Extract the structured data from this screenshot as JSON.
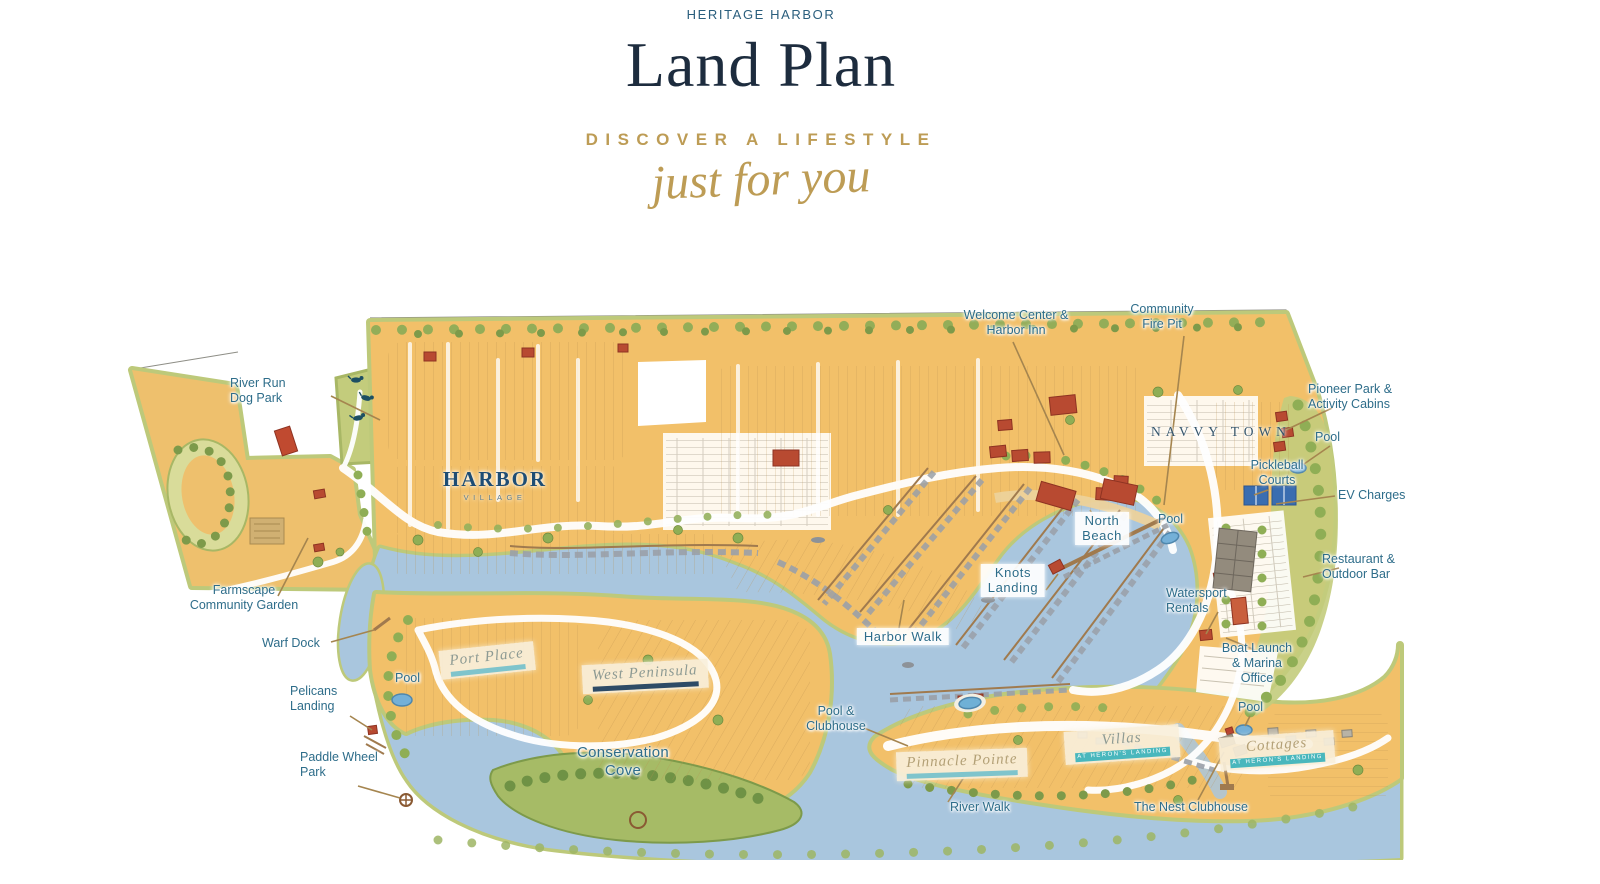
{
  "header": {
    "eyebrow": "HERITAGE HARBOR",
    "title": "Land Plan",
    "tagline": "DISCOVER A LIFESTYLE",
    "script_line": "just for you"
  },
  "map": {
    "districts": {
      "harbor_village": {
        "name": "HARBOR",
        "sub": "VILLAGE"
      },
      "navvy_town": {
        "name": "NAVVY TOWN"
      }
    },
    "banners": {
      "port_place": {
        "name": "Port Place"
      },
      "west_peninsula": {
        "name": "West Peninsula"
      },
      "pinnacle_pointe": {
        "name": "Pinnacle Pointe"
      },
      "villas": {
        "name": "Villas",
        "sub": "AT HERON'S LANDING"
      },
      "cottages": {
        "name": "Cottages",
        "sub": "AT HERON'S LANDING"
      }
    },
    "callouts": {
      "river_run": "River Run\nDog Park",
      "farmscape": "Farmscape\nCommunity Garden",
      "warf_dock": "Warf Dock",
      "pool_left": "Pool",
      "pelicans": "Pelicans\nLanding",
      "paddle_wheel": "Paddle Wheel\nPark",
      "conservation_cove": "Conservation\nCove",
      "harbor_walk": "Harbor Walk",
      "pool_clubhouse": "Pool &\nClubhouse",
      "river_walk": "River Walk",
      "knots_landing": "Knots\nLanding",
      "north_beach": "North\nBeach",
      "pool_mid": "Pool",
      "welcome_center": "Welcome Center &\nHarbor Inn",
      "community_fire_pit": "Community\nFire Pit",
      "pioneer_park": "Pioneer Park &\nActivity Cabins",
      "pool_top_right": "Pool",
      "pickleball": "Pickleball\nCourts",
      "ev_charges": "EV Charges",
      "restaurant": "Restaurant &\nOutdoor Bar",
      "watersport": "Watersport\nRentals",
      "boat_launch": "Boat Launch\n& Marina\nOffice",
      "pool_bottom_right": "Pool",
      "nest_clubhouse": "The Nest Clubhouse"
    },
    "colors": {
      "water": "#a9c6de",
      "land": "#f2c069",
      "greenbelt": "#bdc97a",
      "buildings_red": "#b84a31",
      "label_teal": "#2e6d8a",
      "leader_gold": "#a5854f",
      "header_navy": "#1d2c3e",
      "accent_gold": "#bd9c55"
    }
  }
}
